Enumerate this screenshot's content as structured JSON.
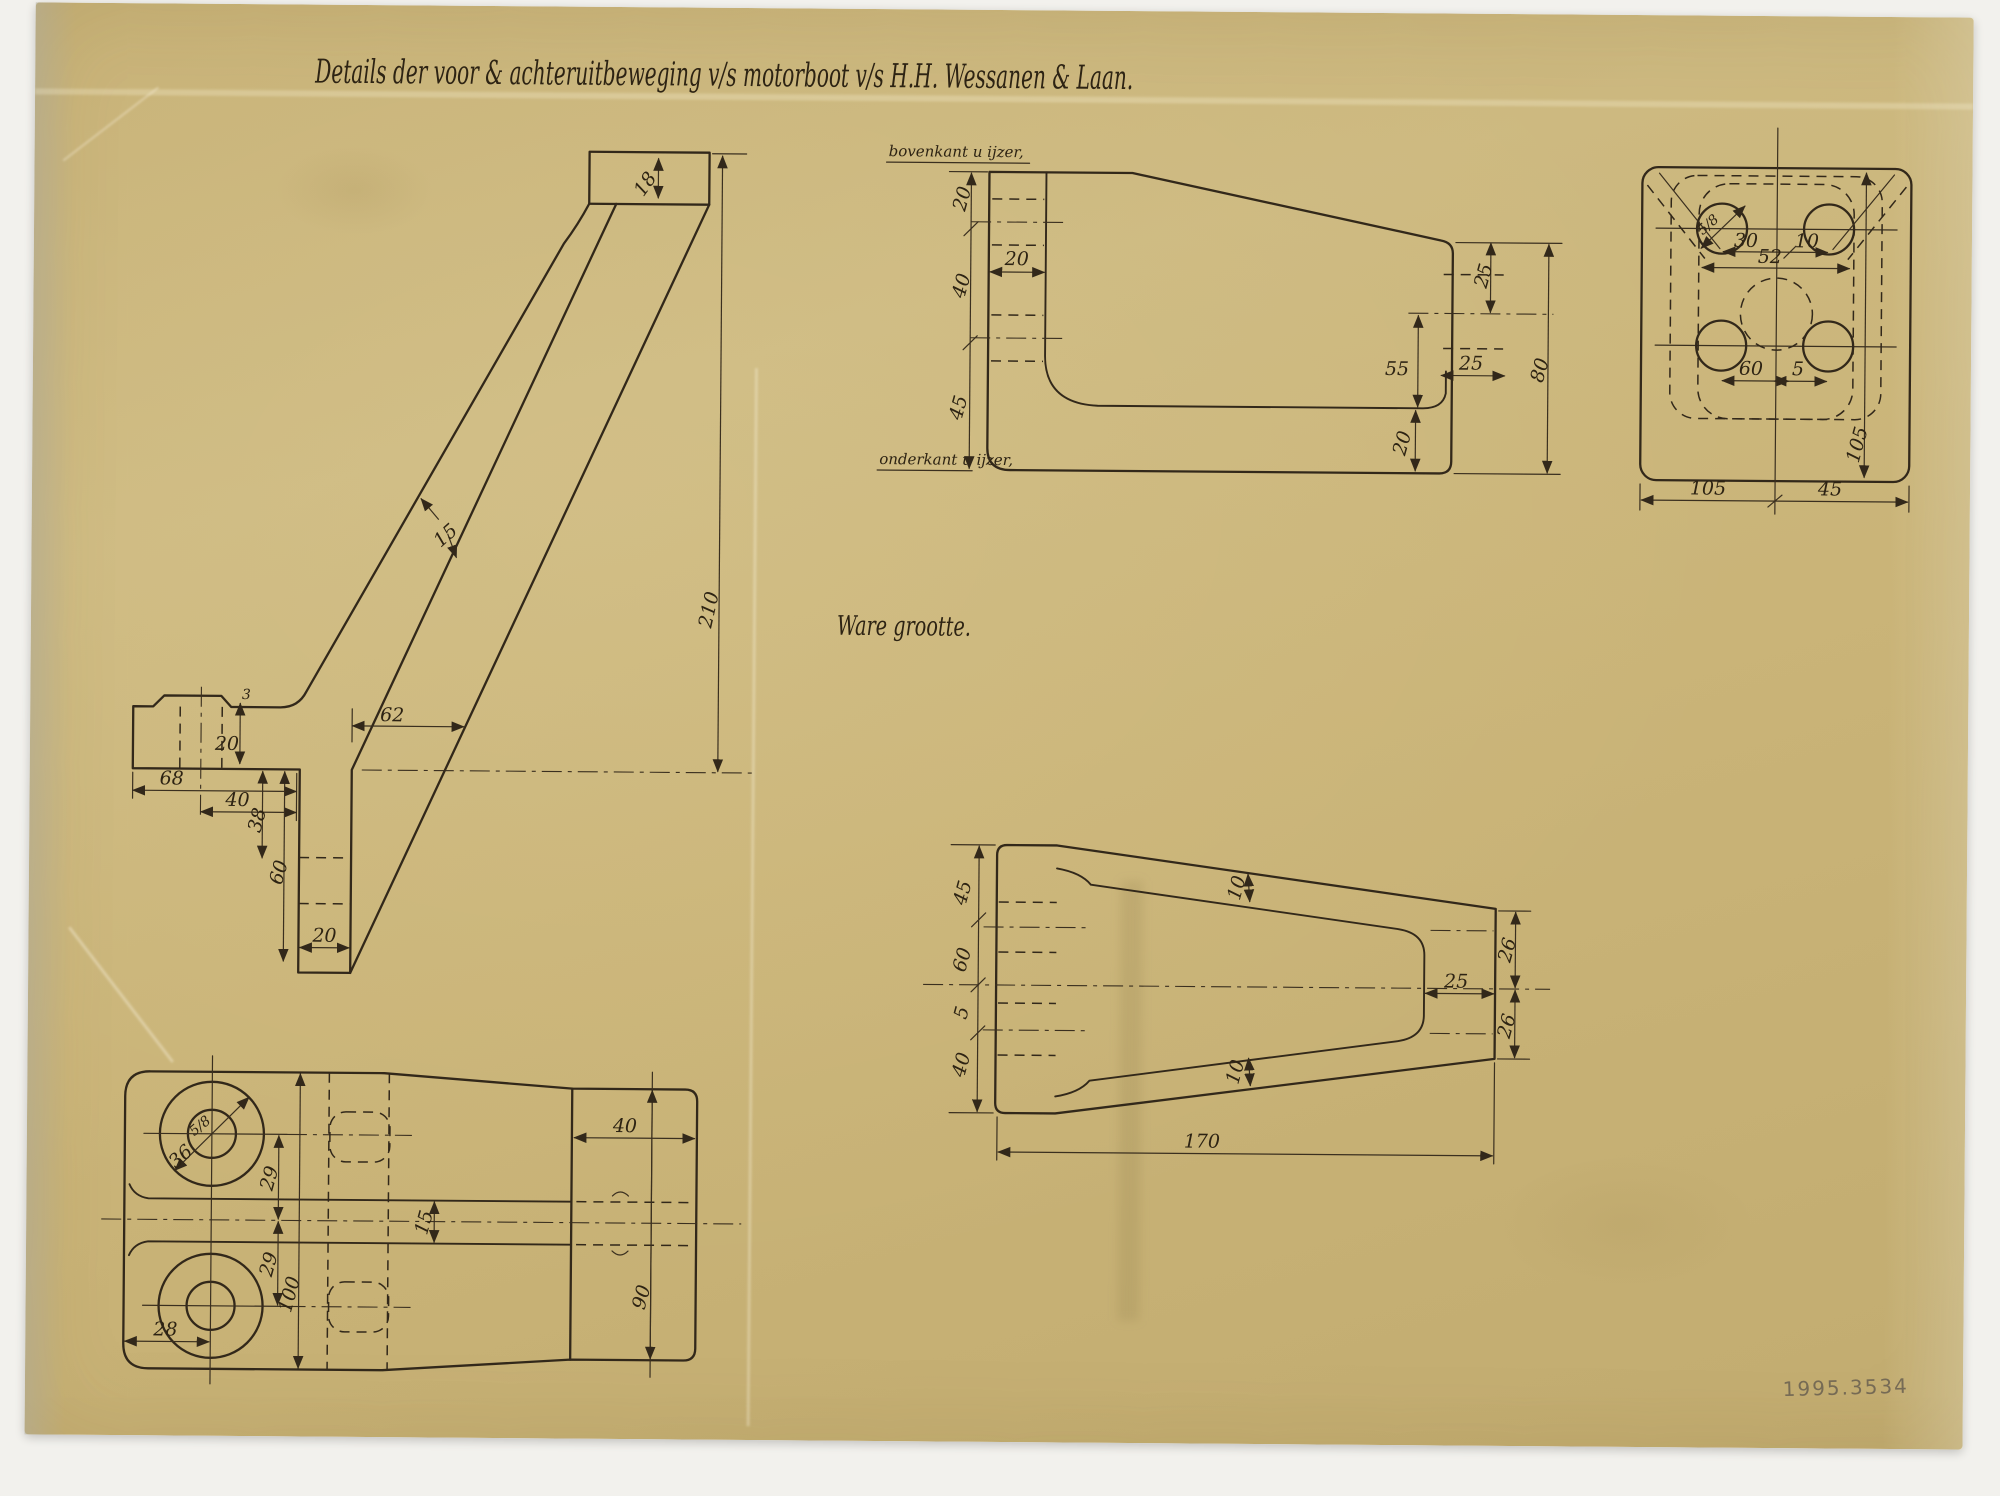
{
  "title": {
    "text": "Details der voor & achteruitbeweging v/s motorboot v/s H.H. Wessanen & Laan."
  },
  "scale_note": "Ware grootte.",
  "stamp": "1995.3534",
  "colors": {
    "paper": "#cab478",
    "ink": "#32281a",
    "stamp_ink": "#6e6452",
    "background": "#f2f1ed"
  },
  "views": {
    "side": {
      "dims": {
        "d18": "18",
        "d15": "15",
        "d62": "62",
        "d210": "210",
        "d20_boss": "20",
        "d3_boss": "3",
        "d68": "68",
        "d40": "40",
        "d38": "38",
        "d60": "60",
        "d20_leg": "20"
      }
    },
    "base_side": {
      "label_top": "bovenkant u ijzer,",
      "label_bottom": "onderkant u ijzer,",
      "dims": {
        "d20_left": "20",
        "d40_left": "40",
        "d45_left": "45",
        "d20_width": "20",
        "d25_top": "25",
        "d25_width": "25",
        "d55": "55",
        "d20_flange": "20",
        "d80": "80"
      }
    },
    "base_plan": {
      "dims": {
        "bolt": "5/8",
        "d30": "30",
        "d10": "10",
        "d52": "52",
        "d60": "60",
        "d5": "5",
        "d105_side": "105",
        "d105_bottom": "105",
        "d45_bottom": "45"
      }
    },
    "arm": {
      "dims": {
        "d45": "45",
        "d60": "60",
        "d5": "5",
        "d40": "40",
        "d10_top": "10",
        "d10_bottom": "10",
        "d25": "25",
        "d26_top": "26",
        "d26_bottom": "26",
        "d170": "170"
      }
    },
    "foot_plan": {
      "dims": {
        "bolt": "5/8",
        "d36": "36",
        "d29_top": "29",
        "d15": "15",
        "d29_bottom": "29",
        "d100": "100",
        "d28": "28",
        "d40": "40",
        "d90": "90"
      }
    }
  }
}
